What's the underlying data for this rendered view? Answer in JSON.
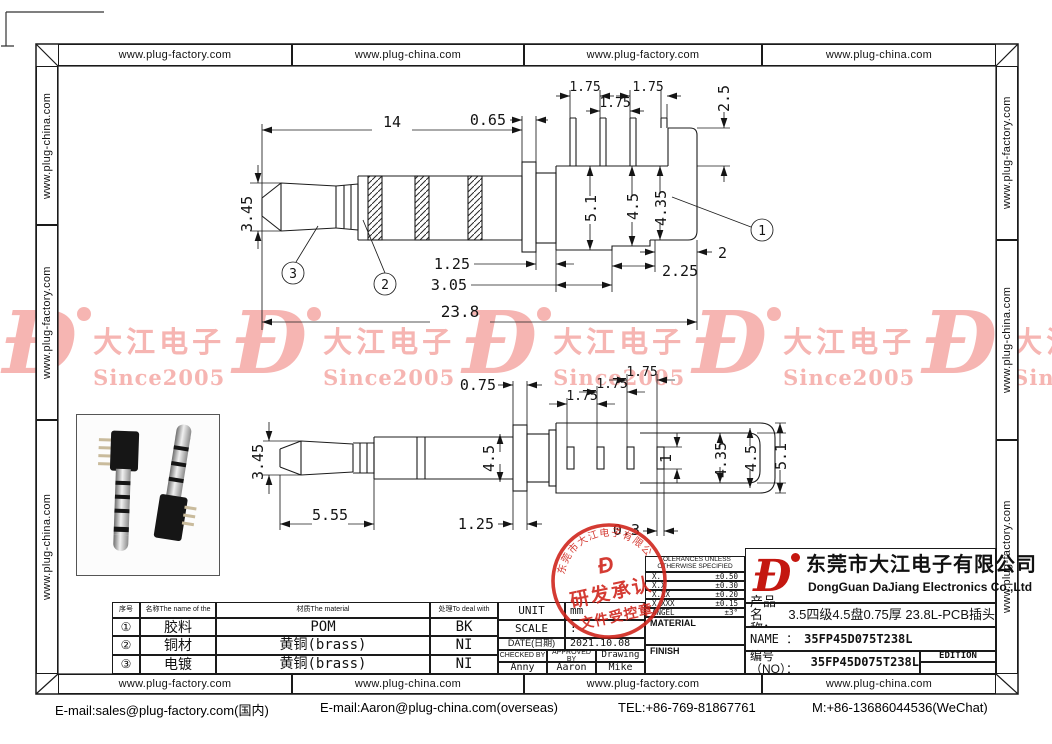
{
  "border": {
    "top_cells": [
      "www.plug-factory.com",
      "www.plug-china.com",
      "www.plug-factory.com",
      "www.plug-china.com"
    ],
    "bottom_cells": [
      "www.plug-factory.com",
      "www.plug-china.com",
      "www.plug-factory.com",
      "www.plug-china.com"
    ],
    "left_cells": [
      "www.plug-china.com",
      "www.plug-factory.com",
      "www.plug-china.com"
    ],
    "right_cells": [
      "www.plug-factory.com",
      "www.plug-china.com",
      "www.plug-factory.com"
    ]
  },
  "watermark": {
    "logo": "Đ",
    "name": "大江电子",
    "since": "Since2005",
    "color": "#f6b5b2"
  },
  "top_view": {
    "len": "14",
    "flange": "0.65",
    "p1": "1.75",
    "p2": "1.75",
    "p3": "1.75",
    "step_h": "2.5",
    "tip": "3.45",
    "h1": "5.1",
    "h2": "4.5",
    "h3": "4.35",
    "w1": "2",
    "w2": "2.25",
    "neck": "1.25",
    "w3": "3.05",
    "total": "23.8",
    "b1": "1",
    "b2": "2",
    "b3": "3"
  },
  "bottom_view": {
    "flange": "0.75",
    "p1": "1.75",
    "p2": "1.75",
    "p3": "1.75",
    "tip": "3.45",
    "neck_h": "4.5",
    "tip_len": "5.55",
    "neck": "1.25",
    "slot": "0.3",
    "slot_w": "1",
    "h3": "4.35",
    "h2": "4.5",
    "h1": "5.1"
  },
  "stamp": {
    "arc": "东莞市大江电子有限公司",
    "logo": "Đ",
    "line1": "研发承认",
    "line2": "文件受控章"
  },
  "materials": {
    "headers": [
      "序号",
      "名称The name of the",
      "材质The material",
      "处理To deal with"
    ],
    "rows": [
      {
        "no": "①",
        "name": "胶料",
        "material": "POM",
        "deal": "BK"
      },
      {
        "no": "②",
        "name": "铜材",
        "material": "黄铜(brass)",
        "deal": "NI"
      },
      {
        "no": "③",
        "name": "电镀",
        "material": "黄铜(brass)",
        "deal": "NI"
      }
    ]
  },
  "info": {
    "unit_label": "UNIT",
    "unit_value": "mm",
    "scale_label": "SCALE",
    "scale_value": ":",
    "date_label": "DATE(日期)",
    "date_value": "2021.10.08",
    "checked_label": "CHECKED BY",
    "approved_label": "APPROVED BY",
    "drawing_label": "Drawing",
    "checked": "Anny",
    "approved": "Aaron",
    "drawing": "Mike"
  },
  "tolerances": {
    "header1": "TOLERANCES UNLESS",
    "header2": "OTHERWISE SPECIFIED",
    "rows": [
      {
        "label": "X.",
        "value": "±0.50"
      },
      {
        "label": "X.X",
        "value": "±0.30"
      },
      {
        "label": "X.XX",
        "value": "±0.20"
      },
      {
        "label": "X.XXX",
        "value": "±0.15"
      },
      {
        "label": "ANGEL",
        "value": "±3°"
      }
    ],
    "material_label": "MATERIAL",
    "finish_label": "FINISH"
  },
  "title_block": {
    "logo": "Đ",
    "company_cn": "东莞市大江电子有限公司",
    "company_en": "DongGuan DaJiang Electronics Co.,Ltd",
    "product_label": "产品名称：",
    "product_value": "3.5四级4.5盘0.75厚 23.8L-PCB插头",
    "name_label": "NAME ：",
    "name_value": "35FP45D075T238L",
    "no_label": "编号（NO）：",
    "no_value": "35FP45D075T238L",
    "edition_label": "EDITION"
  },
  "footer": {
    "email_cn": "E-mail:sales@plug-factory.com(国内)",
    "email_overseas": "E-mail:Aaron@plug-china.com(overseas)",
    "tel": "TEL:+86-769-81867761",
    "mobile": "M:+86-13686044536(WeChat)"
  }
}
